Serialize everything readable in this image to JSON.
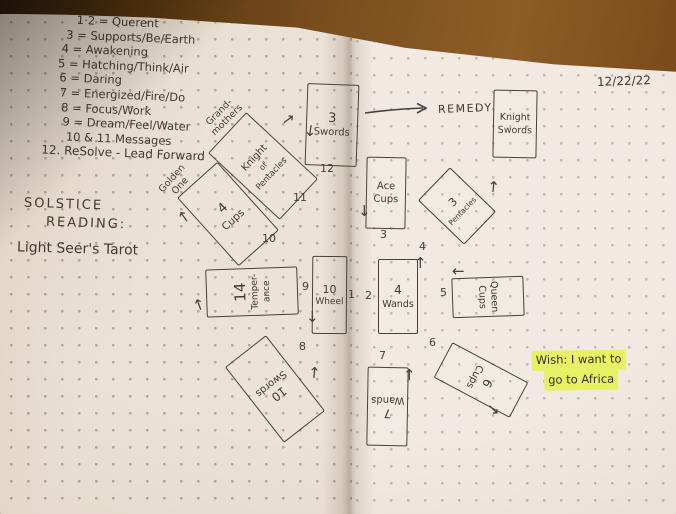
{
  "photo": {
    "date": "12/22/22"
  },
  "key": {
    "lines": [
      "1·2 = Querent",
      "3 = Supports/Be/Earth",
      "4 = Awakening",
      "5 = Hatching/Think/Air",
      "6 = Daring",
      "7 = Energized/Fire/Do",
      "8 = Focus/Work",
      "9 = Dream/Feel/Water",
      "10 & 11 Messages",
      "12. ReSolve - Lead Forward"
    ]
  },
  "titles": {
    "reading_line1": "SOLSTICE",
    "reading_line2": "READING:",
    "deck": "Light Seer's Tarot"
  },
  "remedy": {
    "label": "REMEDY"
  },
  "cards": {
    "wheel": {
      "line1": "10",
      "line2": "Wheel",
      "pos": "1"
    },
    "four_wands": {
      "line1": "4",
      "line2": "Wands",
      "pos": "2"
    },
    "ace_cups": {
      "line1": "Ace",
      "line2": "Cups",
      "pos": "3"
    },
    "three_pentacles": {
      "line1": "3",
      "line2": "Pentacles",
      "pos": "4"
    },
    "queen_cups": {
      "line1": "Queen",
      "line2": "Cups",
      "pos": "5"
    },
    "six_cups": {
      "line1": "6",
      "line2": "Cups",
      "pos": "6"
    },
    "seven_wands": {
      "line1": "7",
      "line2": "Wands",
      "pos": "7"
    },
    "ten_swords": {
      "line1": "10",
      "line2": "Swords",
      "pos": "8"
    },
    "temperance": {
      "line1": "14",
      "line2": "Temper-",
      "line3": "ance",
      "pos": "9"
    },
    "four_cups": {
      "line1": "4",
      "line2": "Cups",
      "pos": "10",
      "note_line1": "Golden",
      "note_line2": "One"
    },
    "knight_pentacles": {
      "line1": "Knight",
      "line2": "of",
      "line3": "Pentacles",
      "pos": "11",
      "note_line1": "Grand-",
      "note_line2": "mothers"
    },
    "three_swords": {
      "line1": "3",
      "line2": "Swords",
      "pos": "12"
    },
    "knight_swords": {
      "line1": "Knight",
      "line2": "Swords"
    }
  },
  "wish": {
    "line1": "Wish: I want to",
    "line2": "go to Africa"
  },
  "icons": {
    "arrow_up": "↑",
    "arrow_down": "↓",
    "arrow_left": "←",
    "arrow_ne": "↗",
    "arrow_se": "↘"
  },
  "colors": {
    "highlight": "#e7f163",
    "ink": "#403a31",
    "paper": "#e9dfd2",
    "wood": "#7b4e20"
  }
}
